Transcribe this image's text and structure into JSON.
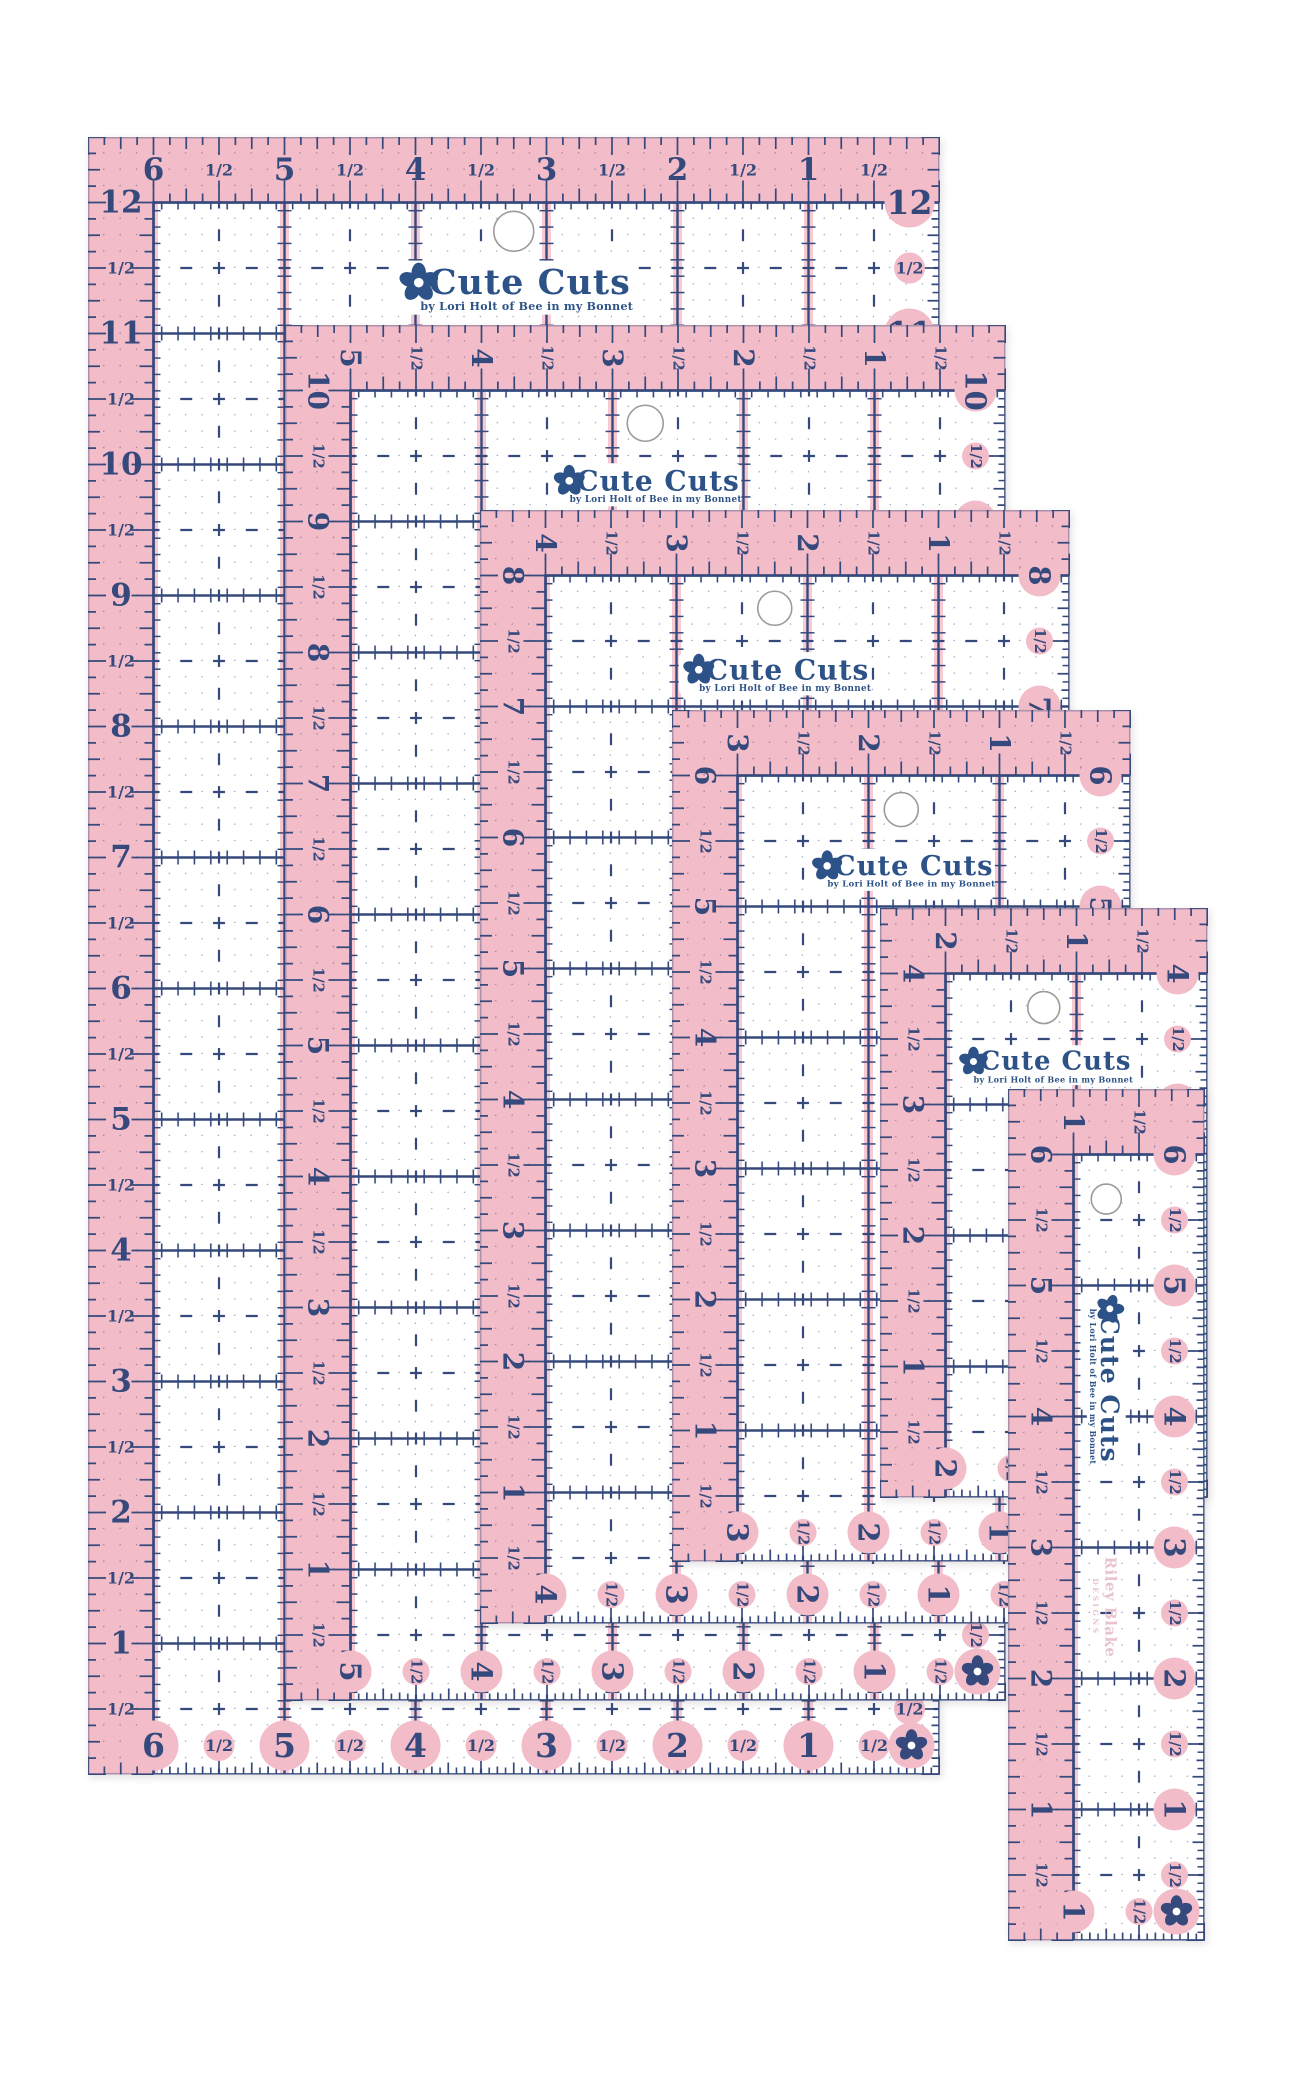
{
  "photo": {
    "background": "#ffffff"
  },
  "colors": {
    "pink": "#f2bcc9",
    "pink_stripe": "#f6c9d3",
    "navy": "#35497c",
    "logo_navy": "#2d5287",
    "white": "#ffffff",
    "hole_ring": "#9b9b9b",
    "watermark_pink": "#e9c3ce",
    "edge_gray": "#d8d8d8"
  },
  "branding": {
    "logo_text": "Cute Cuts",
    "logo_tagline": "by Lori Holt of Bee in my Bonnet",
    "flower_icon": "flower-icon",
    "watermark_line1": "Riley Blake",
    "watermark_line2": "DESIGNS"
  },
  "rulers": [
    {
      "name": "ruler-6-5x12-5",
      "x": 88,
      "y": 137,
      "width_in": 6.5,
      "height_in": 12.5,
      "rotated_labels": false,
      "watermark": false,
      "hole_y_in": 0.72,
      "hole_r": 20,
      "logo_y_in": 1.15,
      "logo_scale": 1.0,
      "top_labels": [
        "6",
        "1/2",
        "5",
        "1/2",
        "4",
        "1/2",
        "3",
        "1/2",
        "2",
        "1/2",
        "1",
        "1/2"
      ],
      "side_labels": [
        "12",
        "1/2",
        "11",
        "1/2",
        "10",
        "1/2",
        "9",
        "1/2",
        "8",
        "1/2",
        "7",
        "1/2",
        "6",
        "1/2",
        "5",
        "1/2",
        "4",
        "1/2",
        "3",
        "1/2",
        "2",
        "1/2",
        "1",
        "1/2"
      ]
    },
    {
      "name": "ruler-5-5x10-5",
      "x": 285,
      "y": 325,
      "width_in": 5.5,
      "height_in": 10.5,
      "rotated_labels": true,
      "watermark": false,
      "hole_y_in": 0.75,
      "hole_r": 18,
      "logo_y_in": 1.22,
      "logo_scale": 0.8,
      "top_labels": [
        "5",
        "1/2",
        "4",
        "1/2",
        "3",
        "1/2",
        "2",
        "1/2",
        "1",
        "1/2"
      ],
      "side_labels": [
        "10",
        "1/2",
        "9",
        "1/2",
        "8",
        "1/2",
        "7",
        "1/2",
        "6",
        "1/2",
        "5",
        "1/2",
        "4",
        "1/2",
        "3",
        "1/2",
        "2",
        "1/2",
        "1",
        "1/2"
      ]
    },
    {
      "name": "ruler-4-5x8-5",
      "x": 480,
      "y": 510,
      "width_in": 4.5,
      "height_in": 8.5,
      "rotated_labels": true,
      "watermark": false,
      "hole_y_in": 0.75,
      "hole_r": 17,
      "logo_y_in": 1.25,
      "logo_scale": 0.8,
      "top_labels": [
        "4",
        "1/2",
        "3",
        "1/2",
        "2",
        "1/2",
        "1",
        "1/2"
      ],
      "side_labels": [
        "8",
        "1/2",
        "7",
        "1/2",
        "6",
        "1/2",
        "5",
        "1/2",
        "4",
        "1/2",
        "3",
        "1/2",
        "2",
        "1/2",
        "1",
        "1/2"
      ]
    },
    {
      "name": "ruler-3-5x6-5",
      "x": 672,
      "y": 710,
      "width_in": 3.5,
      "height_in": 6.5,
      "rotated_labels": true,
      "watermark": false,
      "hole_y_in": 0.76,
      "hole_r": 17,
      "logo_y_in": 1.22,
      "logo_scale": 0.78,
      "top_labels": [
        "3",
        "1/2",
        "2",
        "1/2",
        "1",
        "1/2"
      ],
      "side_labels": [
        "6",
        "1/2",
        "5",
        "1/2",
        "4",
        "1/2",
        "3",
        "1/2",
        "2",
        "1/2",
        "1",
        "1/2"
      ]
    },
    {
      "name": "ruler-2-5x4-5",
      "x": 880,
      "y": 908,
      "width_in": 2.5,
      "height_in": 4.5,
      "rotated_labels": true,
      "watermark": false,
      "hole_y_in": 0.76,
      "hole_r": 16,
      "logo_y_in": 1.2,
      "logo_scale": 0.74,
      "top_labels": [
        "2",
        "1/2",
        "1",
        "1/2"
      ],
      "side_labels": [
        "4",
        "1/2",
        "3",
        "1/2",
        "2",
        "1/2",
        "1",
        "1/2"
      ]
    },
    {
      "name": "ruler-1-5x6-5",
      "x": 1008,
      "y": 1089,
      "width_in": 1.5,
      "height_in": 6.5,
      "rotated_labels": true,
      "watermark": true,
      "hole_y_in": 0.84,
      "hole_r": 15,
      "logo_y_in": 2.2,
      "logo_scale": 0.72,
      "top_labels": [
        "1",
        "1/2"
      ],
      "side_labels": [
        "6",
        "1/2",
        "5",
        "1/2",
        "4",
        "1/2",
        "3",
        "1/2",
        "2",
        "1/2",
        "1",
        "1/2"
      ]
    }
  ]
}
